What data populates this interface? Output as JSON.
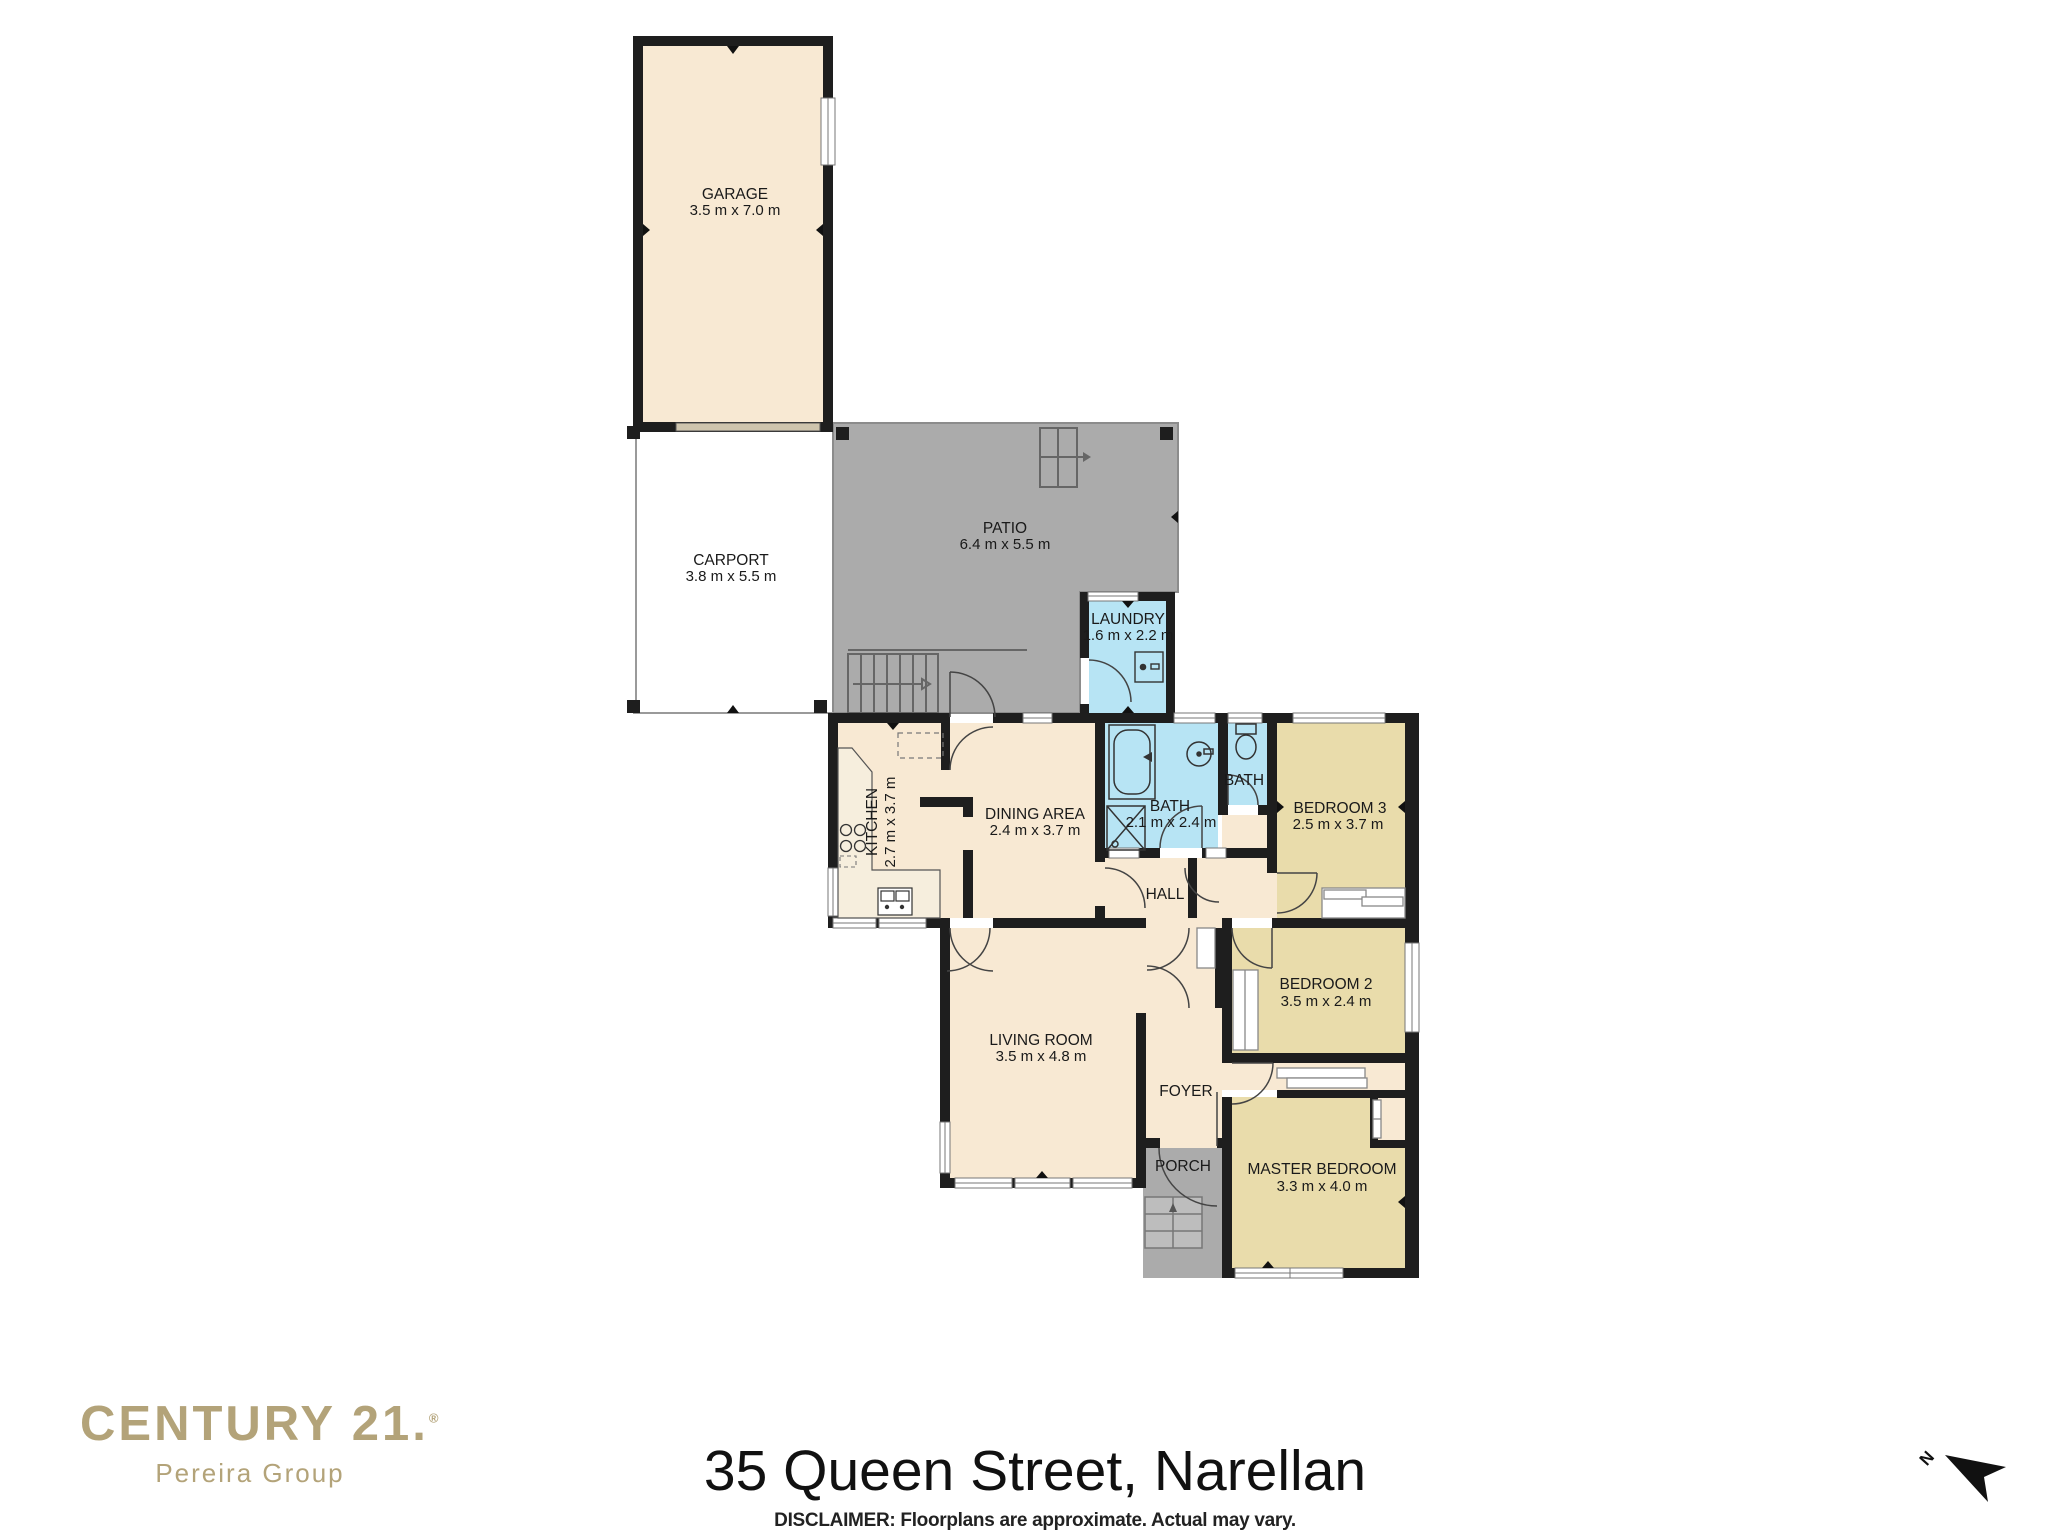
{
  "branding": {
    "brand": "CENTURY 21.",
    "registered": "®",
    "sub_brand": "Pereira Group",
    "brand_color": "#b3a379"
  },
  "title": "35 Queen Street, Narellan",
  "disclaimer": "DISCLAIMER: Floorplans are approximate. Actual may vary.",
  "compass": {
    "label": "N"
  },
  "rooms": {
    "garage": {
      "name": "GARAGE",
      "dims": "3.5 m x 7.0 m"
    },
    "carport": {
      "name": "CARPORT",
      "dims": "3.8 m x 5.5 m"
    },
    "patio": {
      "name": "PATIO",
      "dims": "6.4 m x 5.5 m"
    },
    "laundry": {
      "name": "LAUNDRY",
      "dims": "1.6 m x 2.2 m"
    },
    "kitchen": {
      "name": "KITCHEN",
      "dims": "2.7 m x 3.7 m"
    },
    "dining": {
      "name": "DINING AREA",
      "dims": "2.4 m x 3.7 m"
    },
    "bath": {
      "name": "BATH",
      "dims": "2.1 m x 2.4 m"
    },
    "bath2": {
      "name": "BATH",
      "dims": ""
    },
    "bedroom3": {
      "name": "BEDROOM 3",
      "dims": "2.5 m x 3.7 m"
    },
    "hall": {
      "name": "HALL",
      "dims": ""
    },
    "bedroom2": {
      "name": "BEDROOM 2",
      "dims": "3.5 m x 2.4 m"
    },
    "living": {
      "name": "LIVING ROOM",
      "dims": "3.5 m x 4.8 m"
    },
    "foyer": {
      "name": "FOYER",
      "dims": ""
    },
    "porch": {
      "name": "PORCH",
      "dims": ""
    },
    "master": {
      "name": "MASTER BEDROOM",
      "dims": "3.3 m x 4.0 m"
    }
  },
  "colors": {
    "wall": "#1e1e1e",
    "room_cream": "#f8e9d3",
    "bedroom_tan": "#e9dcab",
    "bath_blue": "#b7e4f4",
    "patio_gray": "#ababab",
    "porch_gray": "#ababab",
    "steps_gray": "#bdbdbd",
    "garage_door_tan": "#cec4ad",
    "white": "#ffffff",
    "text_dark": "#1a1a1a"
  }
}
